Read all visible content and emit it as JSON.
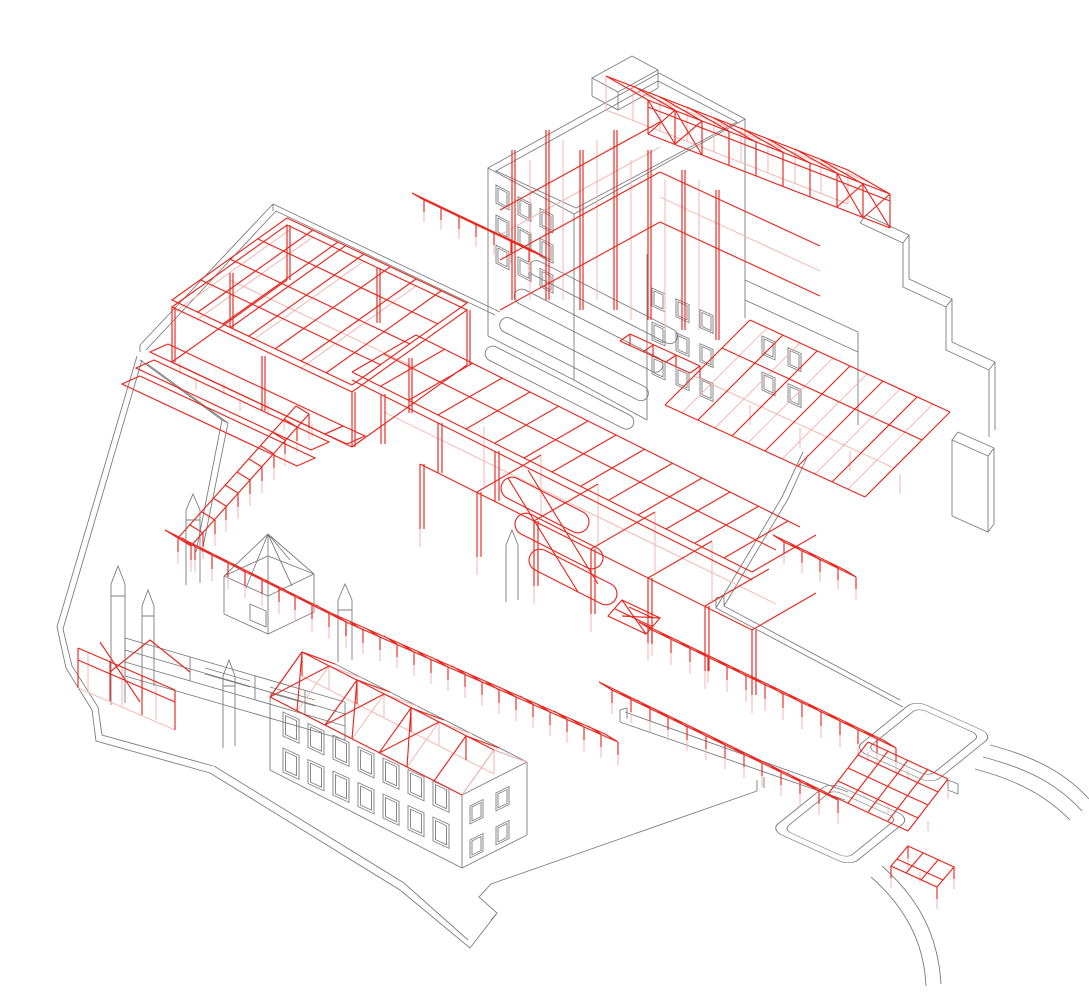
{
  "drawing": {
    "type": "axonometric-architectural-wireframe",
    "background": "#ffffff",
    "colors": {
      "outline": "#7d7d7d",
      "structure": "#e8271f",
      "structure_hidden": "#f5b3ae"
    },
    "components": [
      {
        "id": "site-platform",
        "layer": "context"
      },
      {
        "id": "floor-plate",
        "layer": "context"
      },
      {
        "id": "north-building",
        "layer": "context"
      },
      {
        "id": "balcony-bands",
        "layer": "context"
      },
      {
        "id": "stepped-parapets",
        "layer": "context"
      },
      {
        "id": "courtyard-walls",
        "layer": "context"
      },
      {
        "id": "pavilion-upper",
        "layer": "context"
      },
      {
        "id": "pavilion-lower",
        "layer": "context"
      },
      {
        "id": "curved-paths",
        "layer": "context"
      },
      {
        "id": "banded-wall",
        "layer": "context"
      },
      {
        "id": "towers",
        "layer": "context"
      },
      {
        "id": "kiosk",
        "layer": "context"
      },
      {
        "id": "old-building",
        "layer": "context"
      },
      {
        "id": "upper-frame",
        "layer": "structure"
      },
      {
        "id": "terraces",
        "layer": "structure"
      },
      {
        "id": "central-frame",
        "layer": "structure"
      },
      {
        "id": "spiral-stair",
        "layer": "structure"
      },
      {
        "id": "sloped-roof-frame",
        "layer": "structure"
      },
      {
        "id": "roof-truss-canopy",
        "layer": "structure"
      },
      {
        "id": "building-skeleton",
        "layer": "structure"
      },
      {
        "id": "tower-frame",
        "layer": "structure"
      },
      {
        "id": "pergola-walkways",
        "layer": "structure"
      },
      {
        "id": "footbridge",
        "layer": "structure"
      },
      {
        "id": "trellis-grid",
        "layer": "structure"
      },
      {
        "id": "entrance-canopy",
        "layer": "structure"
      },
      {
        "id": "old-building-roof-trusses",
        "layer": "structure"
      }
    ]
  }
}
